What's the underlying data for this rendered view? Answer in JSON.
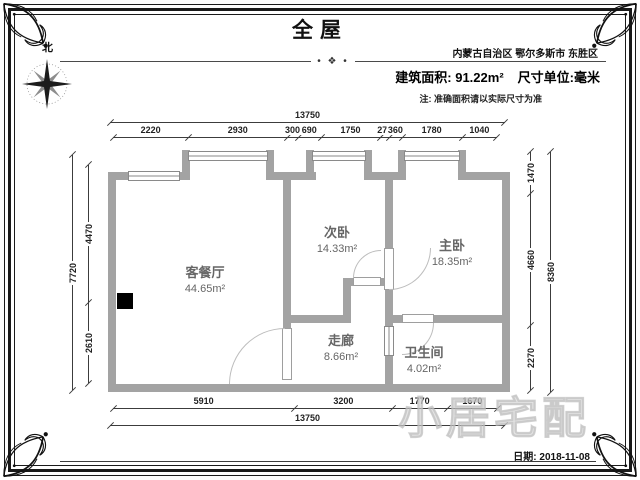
{
  "header": {
    "title": "全屋",
    "region": "内蒙古自治区 鄂尔多斯市 东胜区",
    "area_label": "建筑面积: 91.22m²",
    "unit_label": "尺寸单位:毫米",
    "note": "注: 准确面积请以实际尺寸为准",
    "compass_label": "北"
  },
  "icons": {
    "divider_ornament": "• ❖ •",
    "compass_rose": "8-point-star"
  },
  "rooms": [
    {
      "name": "客餐厅",
      "area": "44.65m²"
    },
    {
      "name": "次卧",
      "area": "14.33m²"
    },
    {
      "name": "主卧",
      "area": "18.35m²"
    },
    {
      "name": "走廊",
      "area": "8.66m²"
    },
    {
      "name": "卫生间",
      "area": "4.02m²"
    }
  ],
  "dims": {
    "top_total": "13750",
    "top_segments": [
      "2220",
      "2930",
      "300",
      "690",
      "1750",
      "270",
      "360",
      "1780",
      "1040"
    ],
    "bottom_segments": [
      "5910",
      "3200",
      "1770",
      "1670"
    ],
    "bottom_total": "13750",
    "left_outer": "7720",
    "left_segments": [
      "4470",
      "2610"
    ],
    "right_segments": [
      "1470",
      "4660",
      "2270"
    ],
    "right_outer": "8360"
  },
  "footer": {
    "date": "日期: 2018-11-08"
  },
  "watermark": "小居宅配",
  "colors": {
    "wall": "#a3a3a3",
    "dim_line": "#3c3c3c",
    "room_text": "#666666",
    "frame": "#1a1a1a"
  }
}
